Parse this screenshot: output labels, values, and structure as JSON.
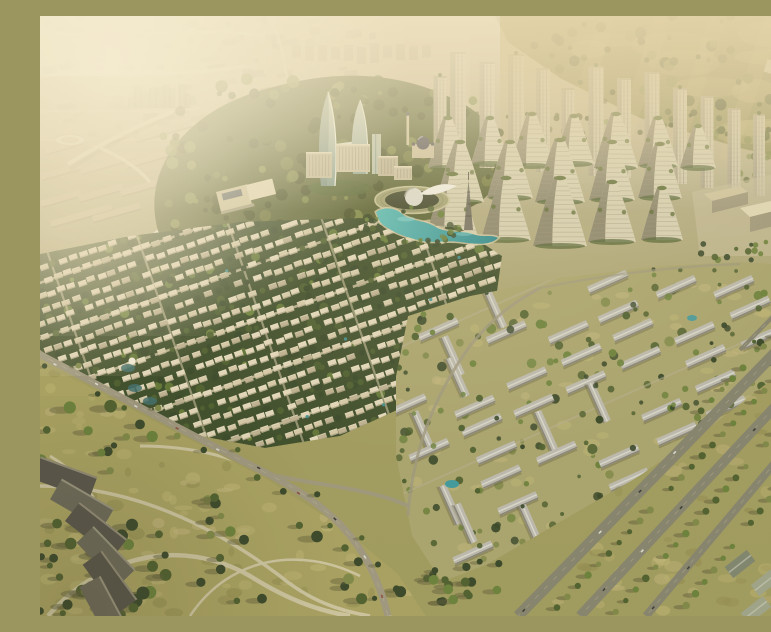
{
  "meta": {
    "title": "Aerial render of a master-planned community at golden hour",
    "alt_text": "Computer-generated aerial view of a large residential master plan: hazy distant city and sunlit hills behind, twin curved glass towers with a sky bridge, a silver dome amphitheater beside a turquoise lagoon, mountain-shaped terraced high-rises backed by slim towers, a dense grid of cream villas with tree-lined rows, gray-roofed townhouse rows, an olive park with winding paths and dark shade terraces, and wide tree-lined boulevards casting long shadows."
  },
  "scene": {
    "type": "natural-image",
    "render_style": "photorealistic CGI aerial masterplan",
    "time_of_day": "late afternoon golden hour",
    "palette": {
      "base_top": "#cfc2a0",
      "base_mid": "#b6ae88",
      "base_low": "#a19b60",
      "haze": "#f2e6c8",
      "glow": "#f8efd6",
      "gold": "#dcc48e",
      "sun": "#f4e4ba",
      "city_block": "#b2a689",
      "city_block_dark": "#a2967c",
      "city_road": "#ddd3b5",
      "hill": "#8f8c56",
      "hill_light": "#c2b47c",
      "forest_dark": "#414a25",
      "forest_mid": "#576034",
      "forest_light": "#71773f",
      "tree_dark": "#36462a",
      "tree_mid": "#4c5e2f",
      "tree_bright": "#69803b",
      "tree_olive": "#7d8748",
      "glass_dark": "#7e978c",
      "glass_light": "#d6e0d2",
      "glass_edge": "#eef3e6",
      "tower_face": "#d1c9ad",
      "tower_shade": "#958d75",
      "tower_stripe": "#a59d84",
      "tower_cap": "#aca383",
      "mtn_light": "#d7d0b4",
      "mtn_mid": "#b6ae92",
      "mtn_dark": "#837c66",
      "mtn_green": "#5c6b35",
      "mtn_stripe": "#9a947c",
      "villa_light": "#e3d9bd",
      "villa_mid": "#d5caab",
      "villa_dark": "#bdb294",
      "villa_shadow": "#8d8468",
      "villa_roof_hi": "#efe6cc",
      "row_roof": "#bcbab0",
      "row_roof_light": "#d9d8d0",
      "row_shade": "#84827a",
      "lagoon_deep": "#27858e",
      "lagoon_light": "#5fc0bd",
      "beach": "#d9d0ab",
      "pond": "#3f6e6e",
      "grass": "#a8a162",
      "grass_light": "#bfb677",
      "grass_dark": "#8f8a50",
      "grass_tan": "#c3b67f",
      "path": "#cfc7a5",
      "road": "#9d9780",
      "road_dark": "#85836f",
      "asphalt": "#6e6c5e",
      "road_line": "#b8b098",
      "shadow": "#5f5e3b",
      "shade_corner": "#3f3d22",
      "shell": "#dcdcd2",
      "shell_hi": "#f2f1ea",
      "bowl_rim": "#a3a276",
      "bowl_inner": "#3c422b",
      "bowl_ring": "#8b8a64",
      "mosque_wall": "#cdbf9f",
      "mosque_dome": "#4e4e5a",
      "box_top": "#cec49f",
      "box_side": "#a1997e",
      "box_lit": "#e0d7b6",
      "terrace_dark": "#55524a",
      "terrace_mid": "#6a665a",
      "terrace_edge": "#b8b098",
      "warehouse": "#9da389",
      "warehouse_dark": "#7e8470",
      "car_dark": "#3c3c38",
      "car_light": "#d8d8d0",
      "car_red": "#8a4f3f",
      "stadium": "#e8e0c4",
      "stadium_inner": "#c4b795",
      "bridge": "#e6dcbd",
      "wing_white": "#f0ead8"
    },
    "regions": [
      {
        "name": "distant-city-background",
        "label": "hazy distant city blocks and roads"
      },
      {
        "name": "hillside-top-right",
        "label": "sunlit olive hills with dark tree clusters"
      },
      {
        "name": "upper-left-district",
        "label": "hazy rows of long low buildings, arena and elevated road"
      },
      {
        "name": "forest-belt",
        "label": "dark forested ridge around the town center"
      },
      {
        "name": "school-campus",
        "label": "flat-roofed campus buildings"
      },
      {
        "name": "slim-highrise-row",
        "label": "row of slender residential towers"
      },
      {
        "name": "mountain-highrise-cluster",
        "label": "mountain-shaped terraced high-rises"
      },
      {
        "name": "civic-boxes-right",
        "label": "large flat-roofed civic halls"
      },
      {
        "name": "landmark-towers",
        "label": "twin curved glass towers with sky bridge"
      },
      {
        "name": "central-midrise-blocks",
        "label": "mid-rise blocks of the town center"
      },
      {
        "name": "mosque",
        "label": "domed mosque with minaret"
      },
      {
        "name": "dome-amphitheater",
        "label": "elliptical bowl with silver dome pavilion"
      },
      {
        "name": "crystal-lagoon",
        "label": "winding turquoise lagoon"
      },
      {
        "name": "observation-spire",
        "label": "lattice observation spire"
      },
      {
        "name": "villa-district",
        "label": "grid of cream villas separated by tree lines"
      },
      {
        "name": "townhouse-district",
        "label": "rows of gray-roofed townhouse blocks among trees"
      },
      {
        "name": "central-park",
        "label": "olive park with winding paths and shade terraces"
      },
      {
        "name": "road-network",
        "label": "diagonal avenue with traffic"
      },
      {
        "name": "boulevard-southeast",
        "label": "wide tree-lined boulevards with long shadows"
      },
      {
        "name": "atmosphere",
        "label": "warm haze and sun glow"
      }
    ]
  }
}
